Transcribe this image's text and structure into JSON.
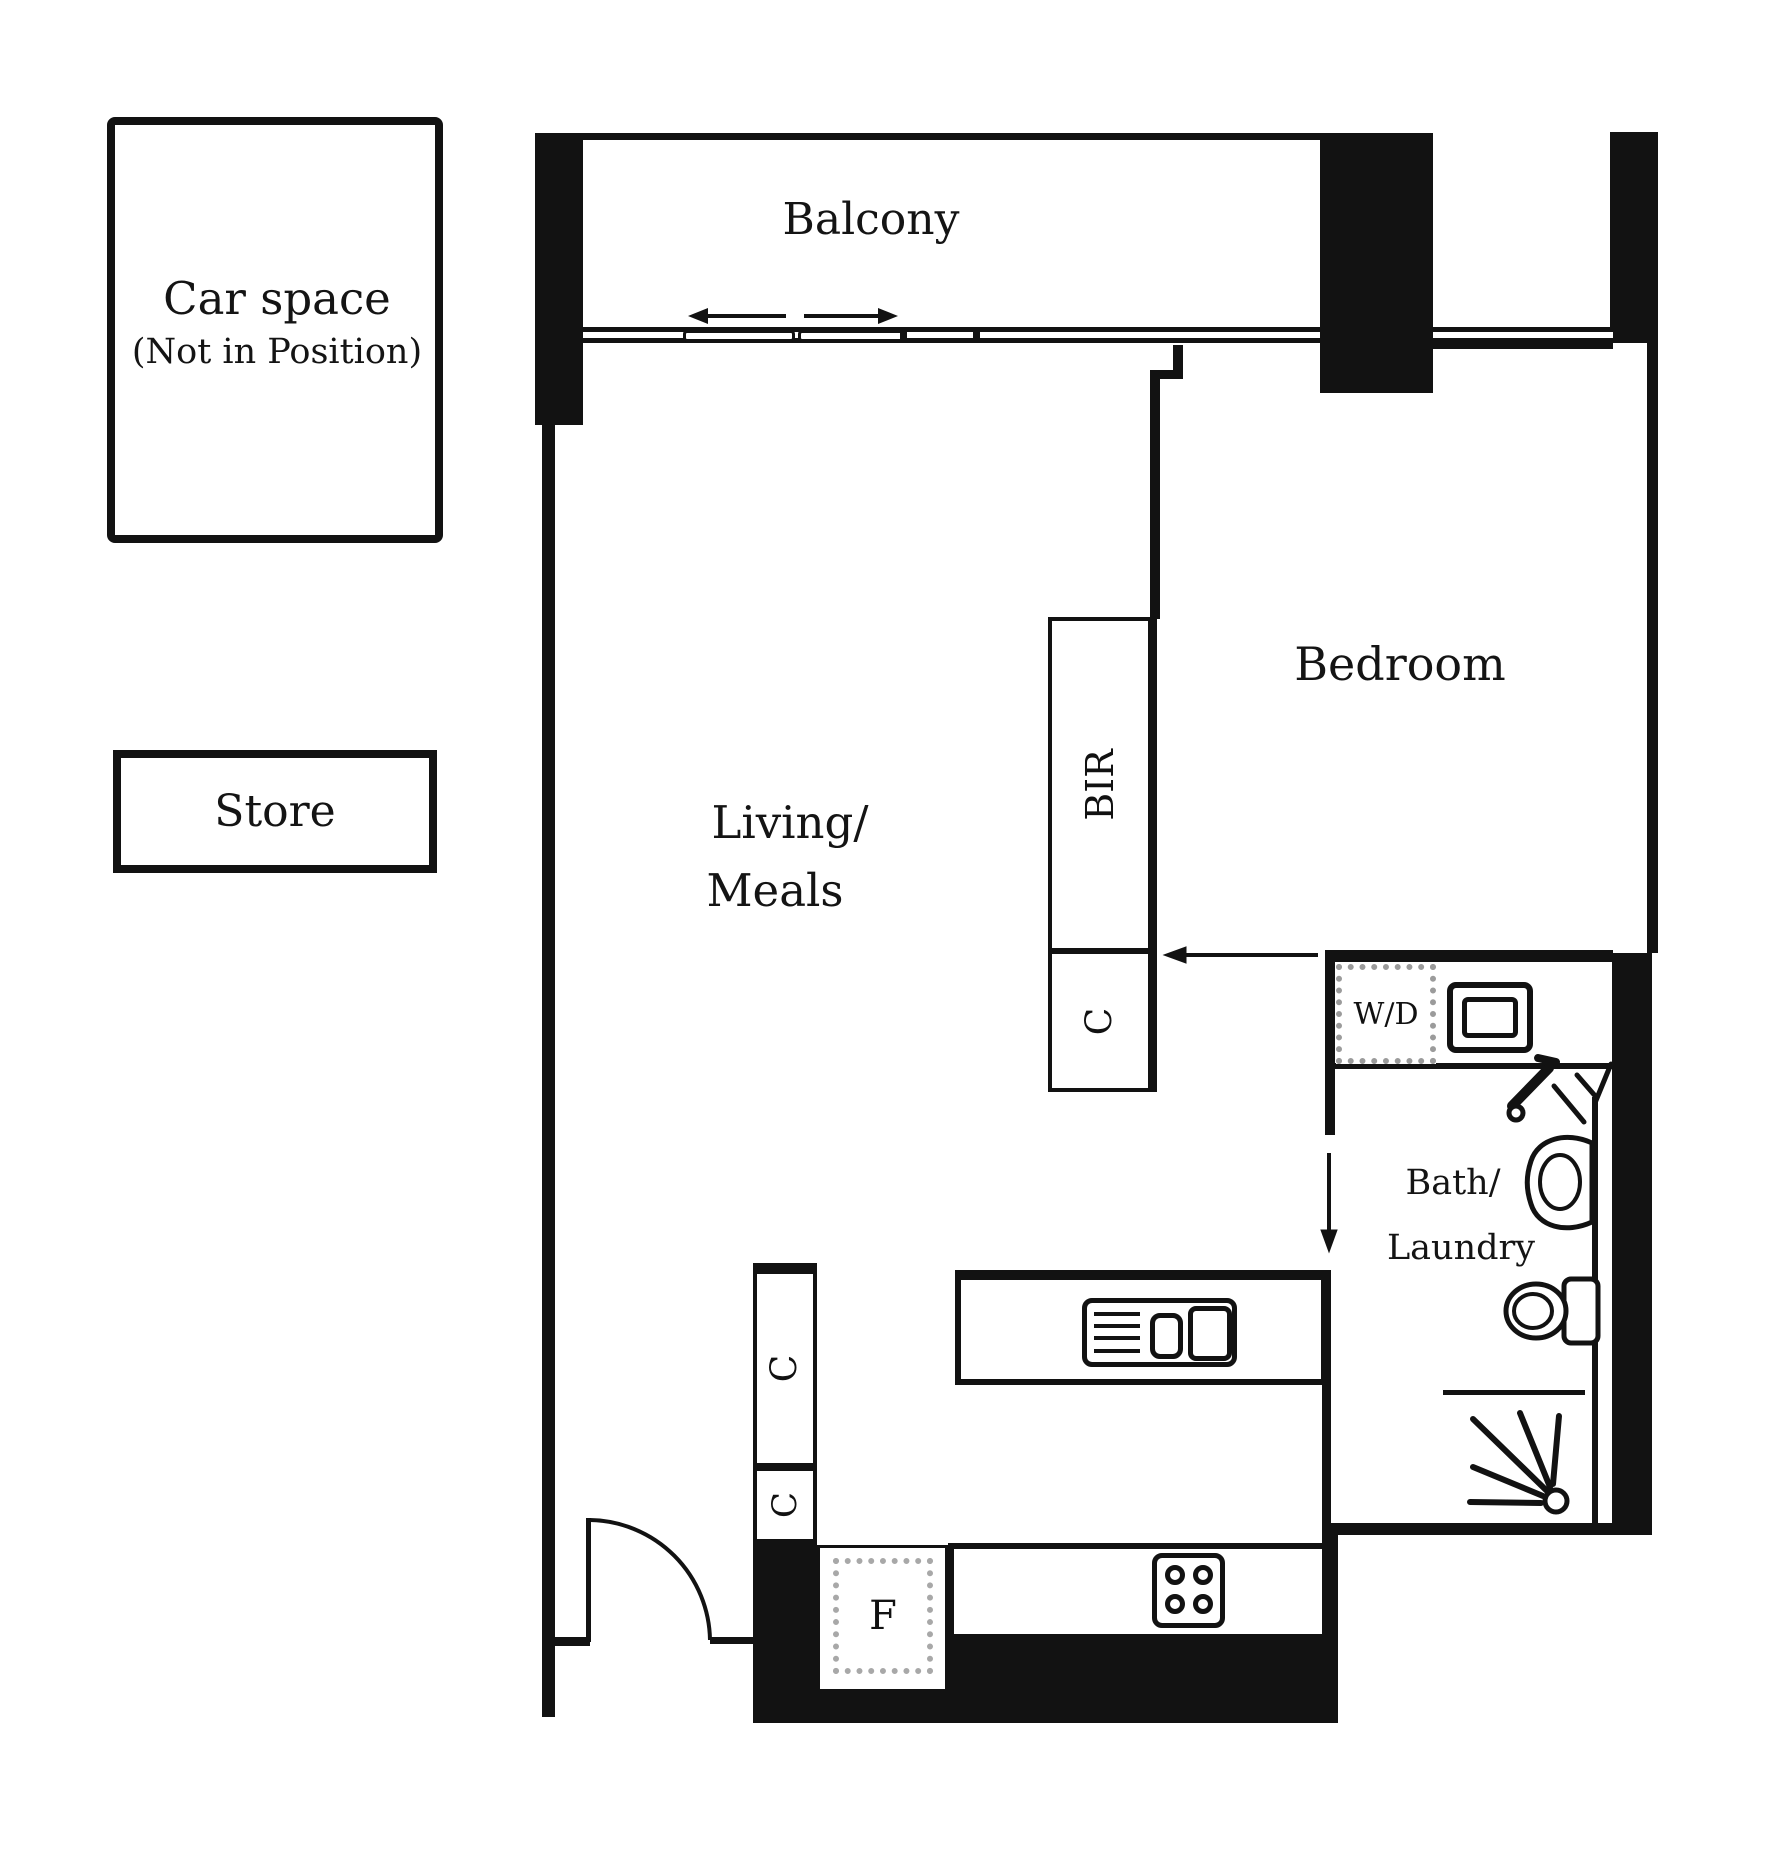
{
  "title": "Apartment floor plan",
  "colors": {
    "wall": "#121212",
    "paper": "#ffffff",
    "dashed_outline": "#9b9b9b"
  },
  "car_space": {
    "label_line1": "Car space",
    "label_line2": "(Not in Position)"
  },
  "store": {
    "label": "Store"
  },
  "rooms": {
    "balcony": "Balcony",
    "bedroom": "Bedroom",
    "living_line1": "Living/",
    "living_line2": "Meals",
    "bath_line1": "Bath/",
    "bath_line2": "Laundry"
  },
  "fixtures": {
    "built_in_robe": "BIR",
    "washer_dryer": "W/D",
    "cupboard": "C",
    "fridge": "F"
  },
  "icons": [
    "sliding-door-arrows-icon",
    "entry-door-swing-icon",
    "bath-door-arrow-icon",
    "bedroom-entry-arrow-icon",
    "laundry-trough-icon",
    "tap-icon",
    "vanity-basin-icon",
    "toilet-icon",
    "shower-spray-icon",
    "kitchen-sink-icon",
    "stove-cooktop-icon"
  ]
}
